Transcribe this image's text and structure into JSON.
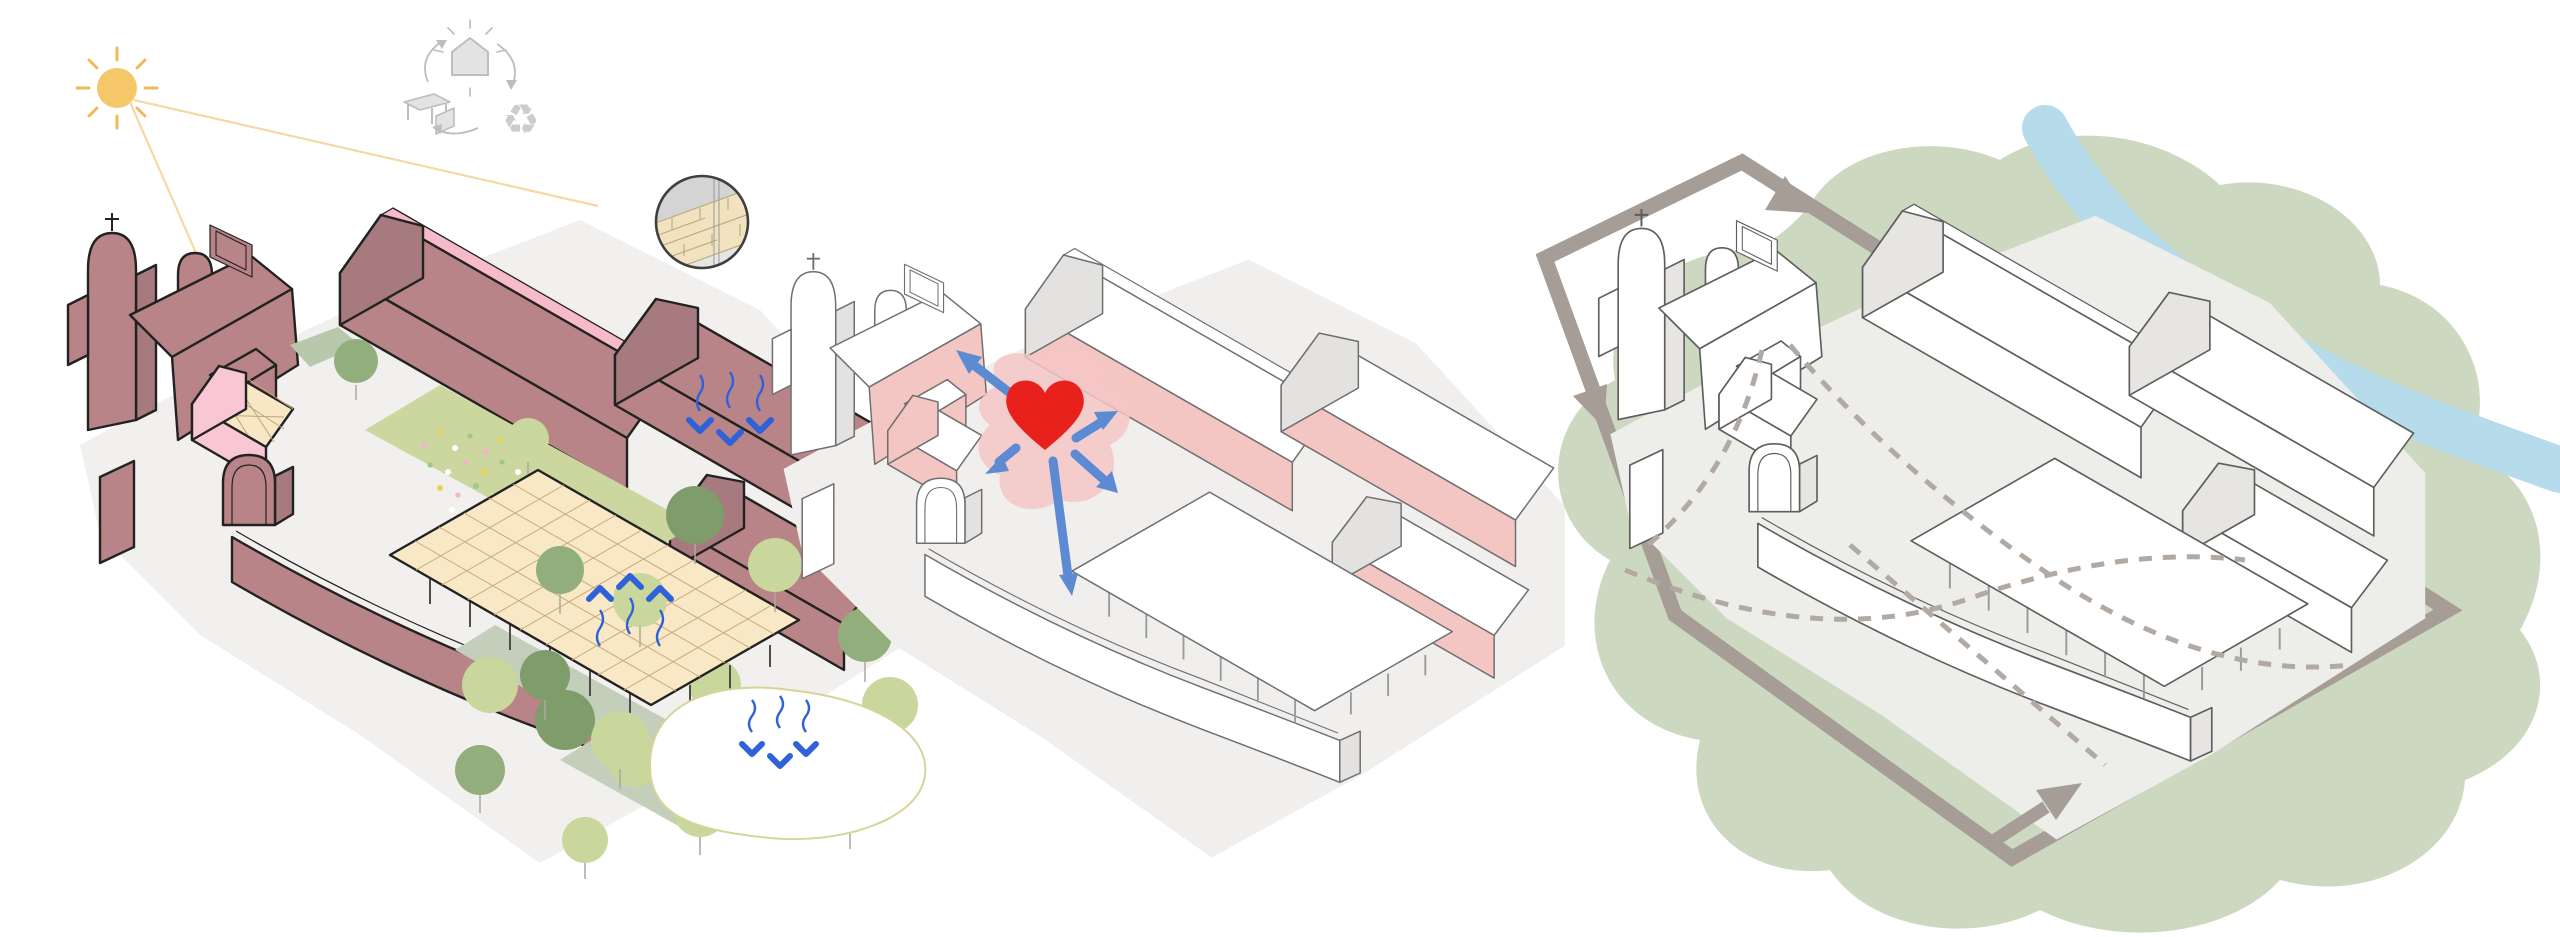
{
  "title_present": false,
  "visible_text": [],
  "glyphs": {
    "recycle": "♻"
  },
  "panels": {
    "left": {
      "name": "massing-materials-environment",
      "icons": [
        "sun-icon",
        "reuse-cycle-icon",
        "wall-detail-callout",
        "rain-arrows-icon",
        "evaporation-arrows-icon",
        "infiltration-arrows-icon"
      ],
      "style": {
        "ground": "#f1f0ee",
        "bf": "#b98487",
        "facade": "#b98487",
        "shade": "#a67a7e",
        "roof": "#b98487",
        "ridge": "#f7bac8",
        "ln": "#222222",
        "lw": "2.4",
        "gh": "#f9c7d3",
        "ghroof": "#f7e7c4",
        "ghgrid": "#c2a377",
        "cfill": "#f8e8c6",
        "cgrid": "#c8a97b",
        "post": "#4d4d4d",
        "lawn": "#ccd7a0",
        "sage": "#b8c8ab",
        "walk": "#c3cfba",
        "treeL": "#c9d69c",
        "treeS": "#93ae7d",
        "treeD": "#7f9c6b",
        "trunk": "#a9a9a1",
        "pond": "#d6d498",
        "blue": "#2f62d9",
        "sun": "#f6c768",
        "ray": "#f0b95a",
        "rayline": "#f5d9a4",
        "meadow1": "#f3b3cb",
        "meadow2": "#e9d44f",
        "meadow3": "#ffffff",
        "meadow4": "#9cc98f",
        "icon": "#bdbdbd",
        "iconfill": "#e3e3e3",
        "callout": "#3f3f3f",
        "brick": "#f2e3c0",
        "brickline": "#b9a87e",
        "detailgray": "#d4d4d4"
      }
    },
    "mid": {
      "name": "community-heart",
      "icons": [
        "heart-icon",
        "radiating-arrows"
      ],
      "style": {
        "ground": "#f0efed",
        "bf": "#ffffff",
        "facade": "#f3c6c3",
        "shade": "#e3e2e0",
        "roof": "#ffffff",
        "ridge": "#ffffff",
        "ln": "#6f6f6f",
        "lw": "1.6",
        "gh": "#f3c6c3",
        "ghroof": "#ffffff",
        "ghgrid": "transparent",
        "cfill": "#ffffff",
        "cgrid": "transparent",
        "post": "#9b9b9b",
        "heart": "#e8211d",
        "blob": "#f4c6c5",
        "arrow": "#5c8bd3"
      }
    },
    "right": {
      "name": "landscape-circulation",
      "icons": [
        "circulation-loop",
        "loop-arrow-icon",
        "river",
        "landscape-blob",
        "dashed-path"
      ],
      "style": {
        "ground": "#ededea",
        "bf": "#ffffff",
        "facade": "#ffffff",
        "shade": "#e6e5e2",
        "roof": "#ffffff",
        "ridge": "#ffffff",
        "ln": "#5e5e5e",
        "lw": "1.7",
        "gh": "#ffffff",
        "ghroof": "#ffffff",
        "ghgrid": "transparent",
        "cfill": "#ffffff",
        "cgrid": "transparent",
        "post": "#9a9a9a",
        "blob": "#cdd8c1",
        "river": "#b6dbeb",
        "loop": "#a69d96",
        "dashed": "#b2a9a2"
      }
    }
  }
}
